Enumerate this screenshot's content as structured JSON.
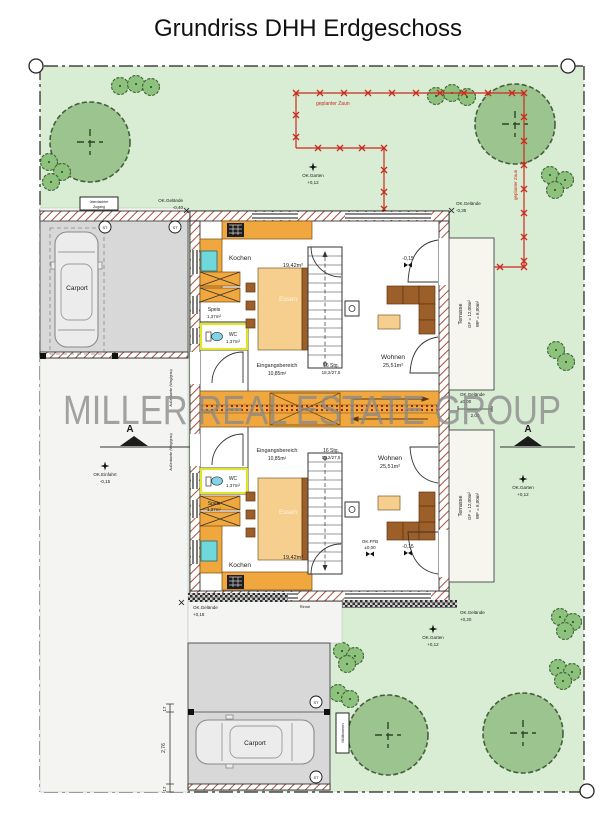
{
  "title": "Grundriss DHH Erdgeschoss",
  "watermark": "MILLER REAL ESTATE GROUP",
  "colors": {
    "lawn": "#d9ecd4",
    "tree": "#9cc48e",
    "bush": "#8cc27c",
    "kitchen_orange": "#f0a73e",
    "furniture_brown": "#9d5f2a",
    "fence_red": "#cc2a1e",
    "carport_gray": "#d8d8d8",
    "sink_teal": "#6fd8dc",
    "watermark_gray": "#8a8a8a",
    "wall_hatch": "#a8503c"
  },
  "fence": {
    "label_horizontal": "geplanter Zaun",
    "label_vertical": "geplanter Zaun"
  },
  "markers": {
    "garten_top": {
      "label": "OK.Garten",
      "value": "+0,12"
    },
    "garten_right": {
      "label": "OK.Garten",
      "value": "+0,12"
    },
    "garten_bottom": {
      "label": "OK.Garten",
      "value": "+0,12"
    },
    "einfahrt": {
      "label": "OK.Einfahrt",
      "value": "-0,15"
    },
    "gelaende_top_left": {
      "label": "OK.Gelände",
      "value": "-0,40"
    },
    "gelaende_top_right": {
      "label": "OK.Gelände",
      "value": "-0,35"
    },
    "gelaende_middle_right": {
      "label": "OK.Gelände",
      "value": "±0,00",
      "dim": "2,00"
    },
    "gelaende_bottom_left": {
      "label": "OK.Gelände",
      "value": "+0,18"
    },
    "gelaende_bottom_right": {
      "label": "OK.Gelände",
      "value": "+0,20"
    }
  },
  "section": {
    "letter": "A"
  },
  "carport": {
    "label": "Carport",
    "post_marker": "ST",
    "sign_top_line1": "überdachter",
    "sign_top_line2": "Zugang",
    "sign_bottom": "Mülltonnen"
  },
  "walkway": {
    "rinne": "Rinne"
  },
  "dimensions": {
    "d17a": "17",
    "d276": "2,76",
    "d17b": "17",
    "side_note": "Außenkante (Weg/grau)"
  },
  "rooms": {
    "kochen": "Kochen",
    "kochen_area": "19,42m²",
    "essen": "Essen",
    "wohnen": "Wohnen",
    "wohnen_area": "25,51m²",
    "wc": "WC",
    "wc_area": "1,37m²",
    "speis": "Speis",
    "speis_area": "1,37m²",
    "eingang": "Eingangsbereich",
    "eingang_area": "10,85m²",
    "stairs_line1": "16 Stg.",
    "stairs_line2": "18,2/27,5",
    "level": "-0,15",
    "ffb_label": "OK.FFB",
    "ffb_value": "±0,00"
  },
  "terrasse": {
    "name": "Terrasse",
    "gf": "GF = 12,00m²",
    "wf": "WF = 6,00m²"
  }
}
